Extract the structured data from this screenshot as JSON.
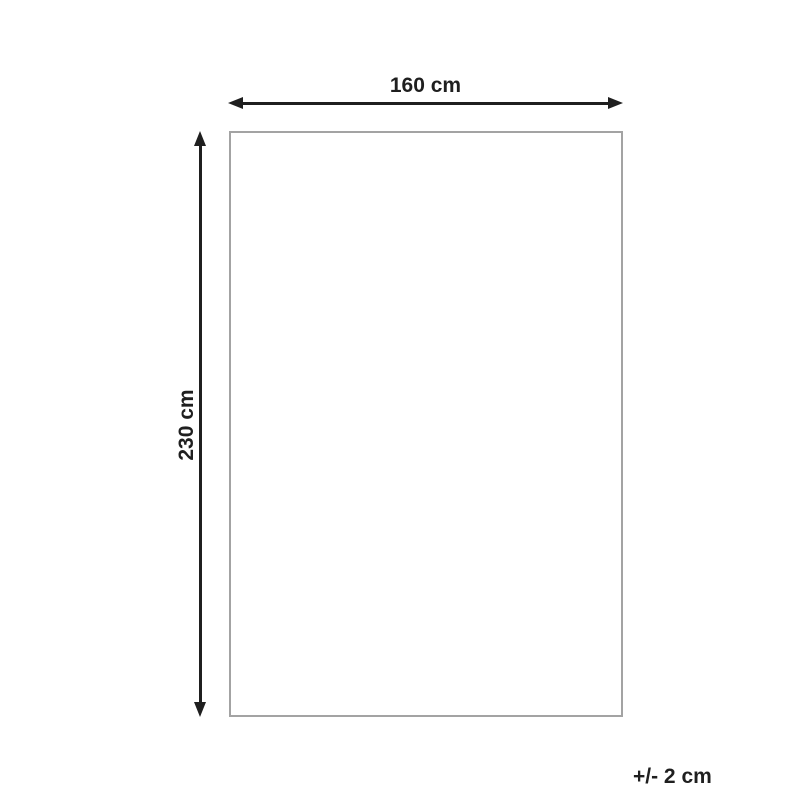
{
  "diagram": {
    "type": "product-dimension-diagram",
    "width_label": "160 cm",
    "height_label": "230 cm",
    "tolerance_label": "+/- 2 cm"
  },
  "colors": {
    "dimension": "#1f1f1f",
    "outline": "#a3a3a3",
    "background": "#ffffff"
  }
}
